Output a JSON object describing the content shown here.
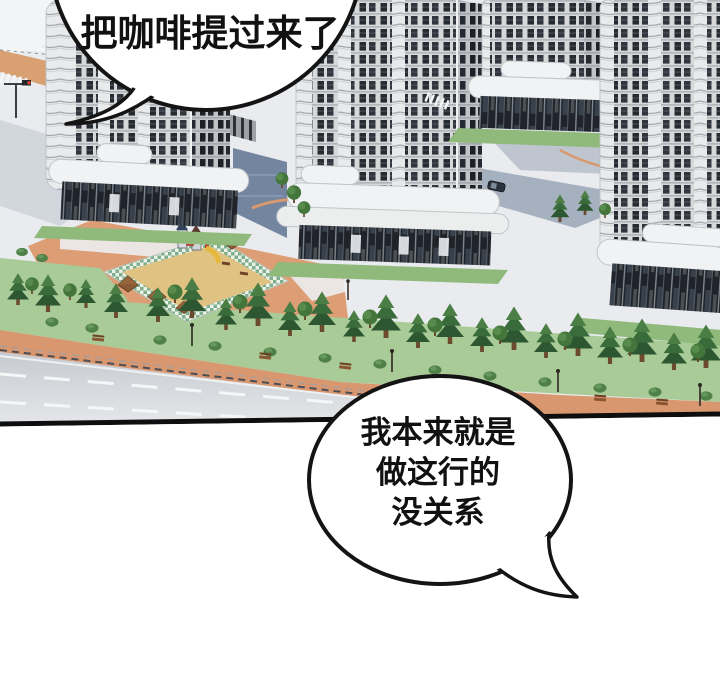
{
  "meta": {
    "type": "webtoon-comic-panel",
    "language": "zh",
    "scene_description": "Aerial isometric 3D view of a high-rise apartment complex: four grey residential towers with dark windows and white podium bases, central playground with checkered border, salmon pedestrian paths, tree belt and a road along the bottom edge."
  },
  "bubbles": {
    "top": {
      "text": "把咖啡提过来了"
    },
    "bottom": {
      "line1": "我本来就是",
      "line2": "做这行的",
      "line3": "没关系"
    }
  },
  "colors": {
    "outline": "#141414",
    "path_salmon": "#dd9d75",
    "lawn": "#a9cb97",
    "lawn_strip": "#8fba7c",
    "sand": "#e0c283",
    "checker_green": "#7fae8e",
    "road_light": "#e4e6e9",
    "road_dark": "#c6cad0",
    "facade": "#d7d8da",
    "window_dark": "#262a31",
    "podium_white": "#f1f2f3",
    "shadow_blue": "#5f7392",
    "tree_dark": "#2d5731"
  }
}
